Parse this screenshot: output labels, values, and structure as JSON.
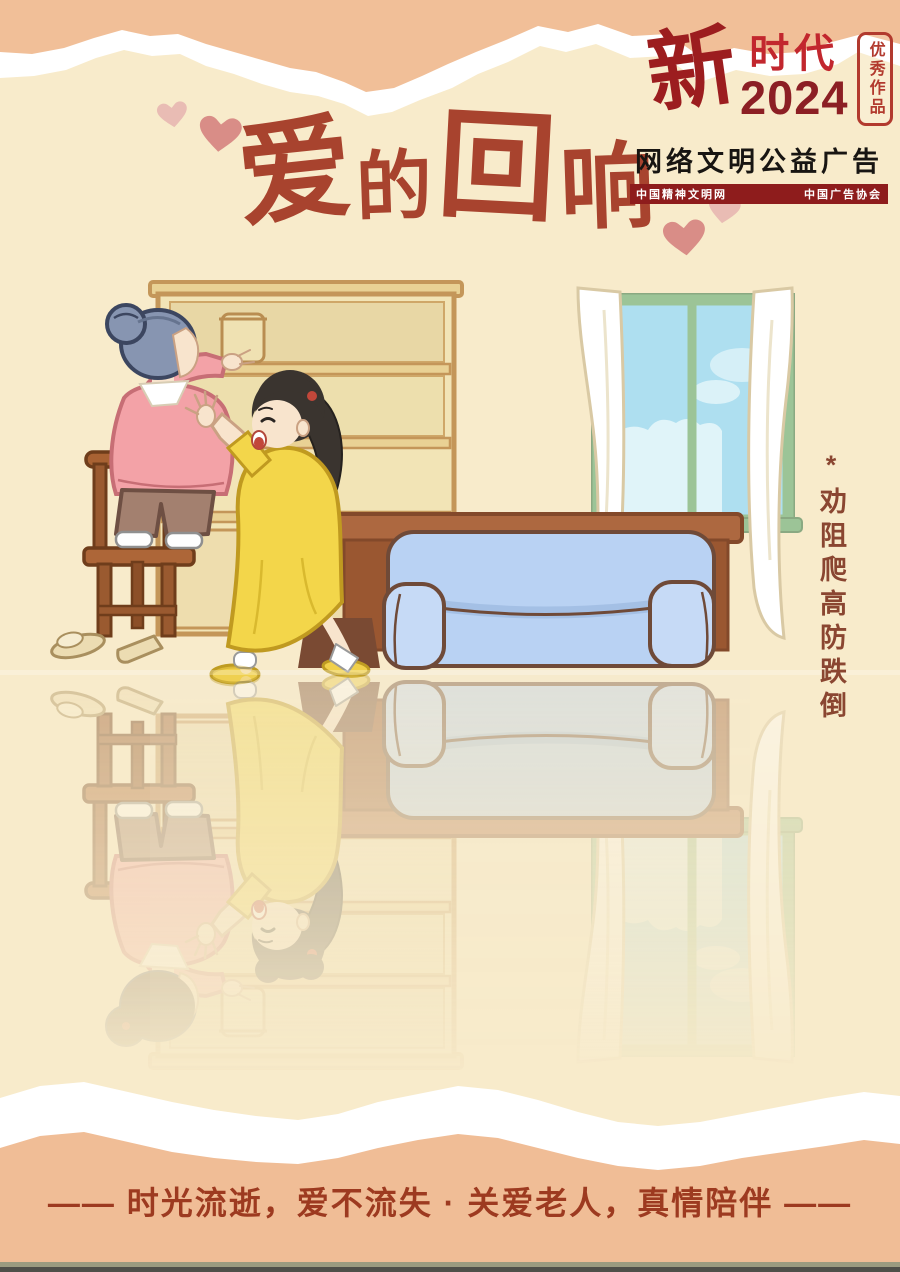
{
  "poster": {
    "badge": {
      "brand_char": "新",
      "brand_word": "时代",
      "year": "2024",
      "seal_text": "优秀作品",
      "campaign_line": "网络文明公益广告",
      "org_left": "中国精神文明网",
      "org_right": "中国广告协会"
    },
    "title": {
      "chars": [
        "爱",
        "的",
        "回",
        "响"
      ]
    },
    "side_note": "*劝阻爬高防跌倒",
    "slogan": "—— 时光流逝，爱不流失 · 关爱老人，真情陪伴 ——",
    "colors": {
      "paper_cream": "#f8ebcb",
      "band_salmon": "#f1bf98",
      "torn_edge_white": "#ffffff",
      "title_rust": "#a8432e",
      "badge_red": "#c2272e",
      "badge_dark_red": "#8e1c1c",
      "slogan_red": "#9d3a20",
      "side_note_brown": "#8a4631",
      "heart_pink_dark": "#d98d87",
      "heart_pink_light": "#e9bcb4",
      "sofa_blue": "#b9d2f3",
      "window_sky": "#aedff0",
      "window_frame_green": "#9cc497",
      "wood_brown": "#a96239",
      "shelf_cream": "#f2e4b6",
      "footer_strip_olive": "#9b9b80",
      "footer_strip_dark": "#4f4f49"
    }
  }
}
